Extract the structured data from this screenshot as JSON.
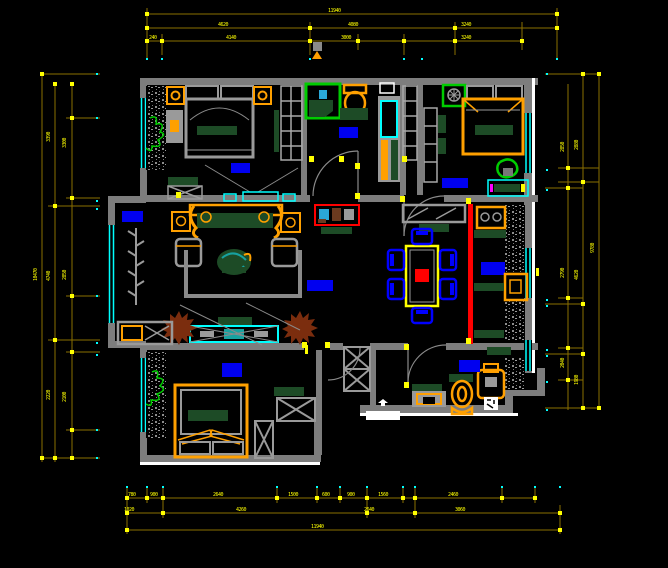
{
  "drawing": {
    "title": "residential-apartment-floor-plan",
    "style": "cad-black-background",
    "colors": {
      "background": "#000000",
      "walls": "#7d7d7d",
      "walls_outer_highlight": "#ffffff",
      "windows": "#00ffff",
      "furniture_accent": "#ffa000",
      "dimension_line": "#8a6f00",
      "dimension_text": "#ffff00",
      "room_label": "#0000f0",
      "cushion_green": "#1d4b26",
      "plant_green": "#00cc00",
      "plant_brown": "#7b2d0e",
      "highlight_red": "#ff0000",
      "dining_table": "#ffff00",
      "chair_blue": "#0000ff"
    }
  },
  "dimensions": {
    "top": {
      "row1": [
        "11940"
      ],
      "row2": [
        "4620",
        "4080",
        "3240"
      ],
      "row3": [
        "240",
        "4140",
        "3000",
        "3240"
      ]
    },
    "bottom": {
      "row1": [
        "780",
        "900",
        "2640",
        "1500",
        "600",
        "900",
        "1560",
        "2460"
      ],
      "row2": [
        "1020",
        "4260",
        "2640",
        "3060"
      ],
      "row3": [
        "11940"
      ]
    },
    "left": {
      "inner": [
        "3300",
        "2850",
        "2100"
      ],
      "mid": [
        "3390",
        "4740",
        "2220"
      ],
      "outer": [
        "10470"
      ]
    },
    "right": {
      "inner": [
        "2850",
        "2790",
        "2040"
      ],
      "mid": [
        "2880",
        "4620",
        "1980"
      ],
      "outer": [
        "9780"
      ]
    }
  }
}
